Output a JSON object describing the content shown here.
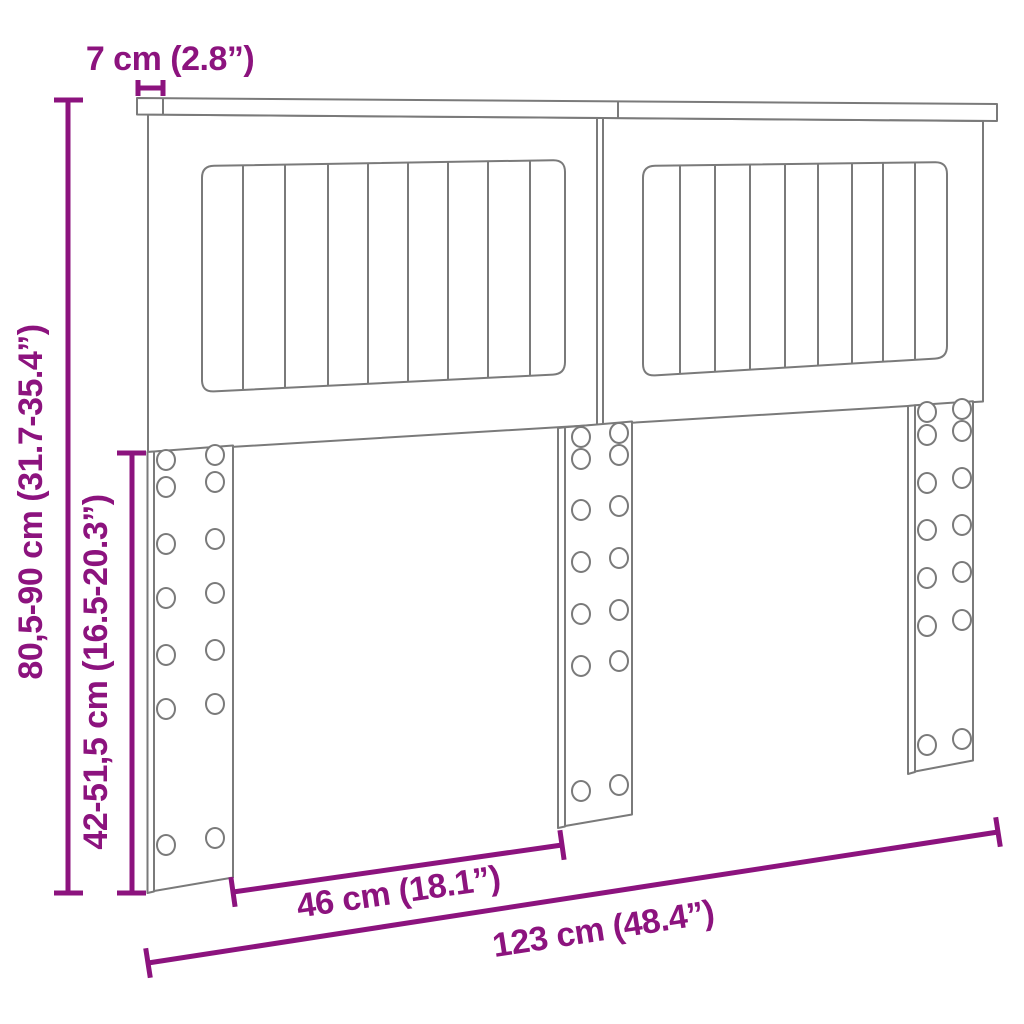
{
  "diagram": {
    "type": "product-dimension-diagram",
    "subject": "Headboard with two slatted panels, top rail and three mounting legs with screw holes",
    "colors": {
      "dimension_accent": "#8c137e",
      "drawing_outline": "#7a7a7a",
      "background": "#ffffff"
    },
    "dimensions": {
      "rail_overhang": "7 cm (2.8”)",
      "overall_height": "80,5-90 cm (31.7-35.4”)",
      "leg_height": "42-51,5 cm (16.5-20.3”)",
      "leg_spacing": "46 cm (18.1”)",
      "overall_width": "123 cm (48.4”)"
    }
  }
}
